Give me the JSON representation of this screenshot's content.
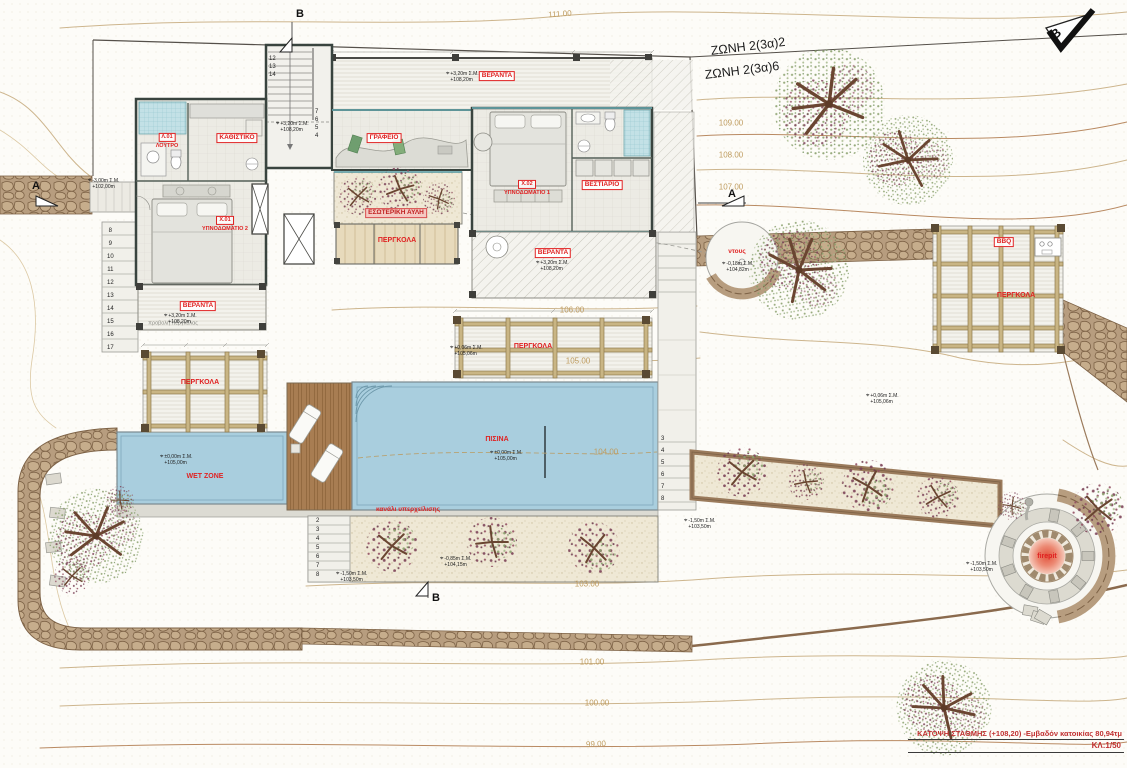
{
  "sheet": {
    "title": "ΚΑΤΟΨΗ ΣΤΑΘΜΗΣ (+108,20) -Εμβαδόν κατοικίας 80,94τμ",
    "scale": "ΚΛ:1/50"
  },
  "zones": {
    "zone_a": "ΖΩΝΗ 2(3α)2",
    "zone_b": "ΖΩΝΗ 2(3α)6"
  },
  "north_marker": "B",
  "section_markers": {
    "top": "B",
    "bottom": "B",
    "left": "A",
    "right": "A"
  },
  "contours": [
    "111.00",
    "109.00",
    "108.00",
    "107.00",
    "106.00",
    "105.00",
    "104.00",
    "103.00",
    "101.00",
    "100.00",
    "99.00"
  ],
  "rooms": {
    "living": "ΚΑΘΙΣΤΙΚΟ",
    "office": "ΓΡΑΦΕΙΟ",
    "bath_code": "Λ.01",
    "bath_name": "ΛΟΥΤΡΟ",
    "bedroom1_code": "Χ.02",
    "bedroom1_name": "ΥΠΝΟΔΩΜΑΤΙΟ 1",
    "bedroom2_code": "Χ.01",
    "bedroom2_name": "ΥΠΝΟΔΩΜΑΤΙΟ 2",
    "wardrobe": "ΒΕΣΤΙΑΡΙΟ",
    "veranda": "ΒΕΡΑΝΤΑ"
  },
  "outdoor": {
    "courtyard": "ΕΣΩΤΕΡΙΚΗ ΑΥΛΗ",
    "pergola": "ΠΕΡΓΚΟΛΑ",
    "pool": "ΠΙΣΙΝΑ",
    "wet_zone": "WET ZONE",
    "overflow_channel": "κανάλι υπερχείλισης",
    "shower": "ντους",
    "bbq": "BBQ",
    "firepit": "firepit",
    "pergola_projection": "προβολή πέργκολας"
  },
  "elevations": [
    {
      "rel": "+3,20m Σ.Μ.",
      "abs": "+108,20m"
    },
    {
      "rel": "+3,20m Σ.Μ.",
      "abs": "+108,20m"
    },
    {
      "rel": "+3,20m Σ.Μ.",
      "abs": "+108,20m"
    },
    {
      "rel": "+3,20m Σ.Μ.",
      "abs": "+108,20m"
    },
    {
      "rel": "-3,00m Σ.Μ.",
      "abs": "+102,00m"
    },
    {
      "rel": "±0,00m Σ.Μ.",
      "abs": "+105,00m"
    },
    {
      "rel": "±0,00m Σ.Μ.",
      "abs": "+105,00m"
    },
    {
      "rel": "-0,18m Σ.Μ.",
      "abs": "+104,82m"
    },
    {
      "rel": "+0,06m Σ.Μ.",
      "abs": "+105,06m"
    },
    {
      "rel": "+0,06m Σ.Μ.",
      "abs": "+105,06m"
    },
    {
      "rel": "-1,50m Σ.Μ.",
      "abs": "+103,50m"
    },
    {
      "rel": "-0,85m Σ.Μ.",
      "abs": "+104,15m"
    },
    {
      "rel": "-1,50m Σ.Μ.",
      "abs": "+103,50m"
    },
    {
      "rel": "-1,50m Σ.Μ.",
      "abs": "+103,50m"
    }
  ],
  "stairs": {
    "hall_upper": [
      "12",
      "13",
      "14"
    ],
    "hall_lower": [
      "7",
      "6",
      "5",
      "4"
    ],
    "west_steps": [
      "8",
      "9",
      "10",
      "11",
      "12",
      "13",
      "14",
      "15",
      "16",
      "17"
    ],
    "garden_steps": [
      "2",
      "3",
      "4",
      "5",
      "6",
      "7",
      "8"
    ],
    "pool_steps": [
      "3",
      "4",
      "5",
      "6",
      "7",
      "8"
    ]
  },
  "icons": {
    "level_marker": "⌖"
  }
}
